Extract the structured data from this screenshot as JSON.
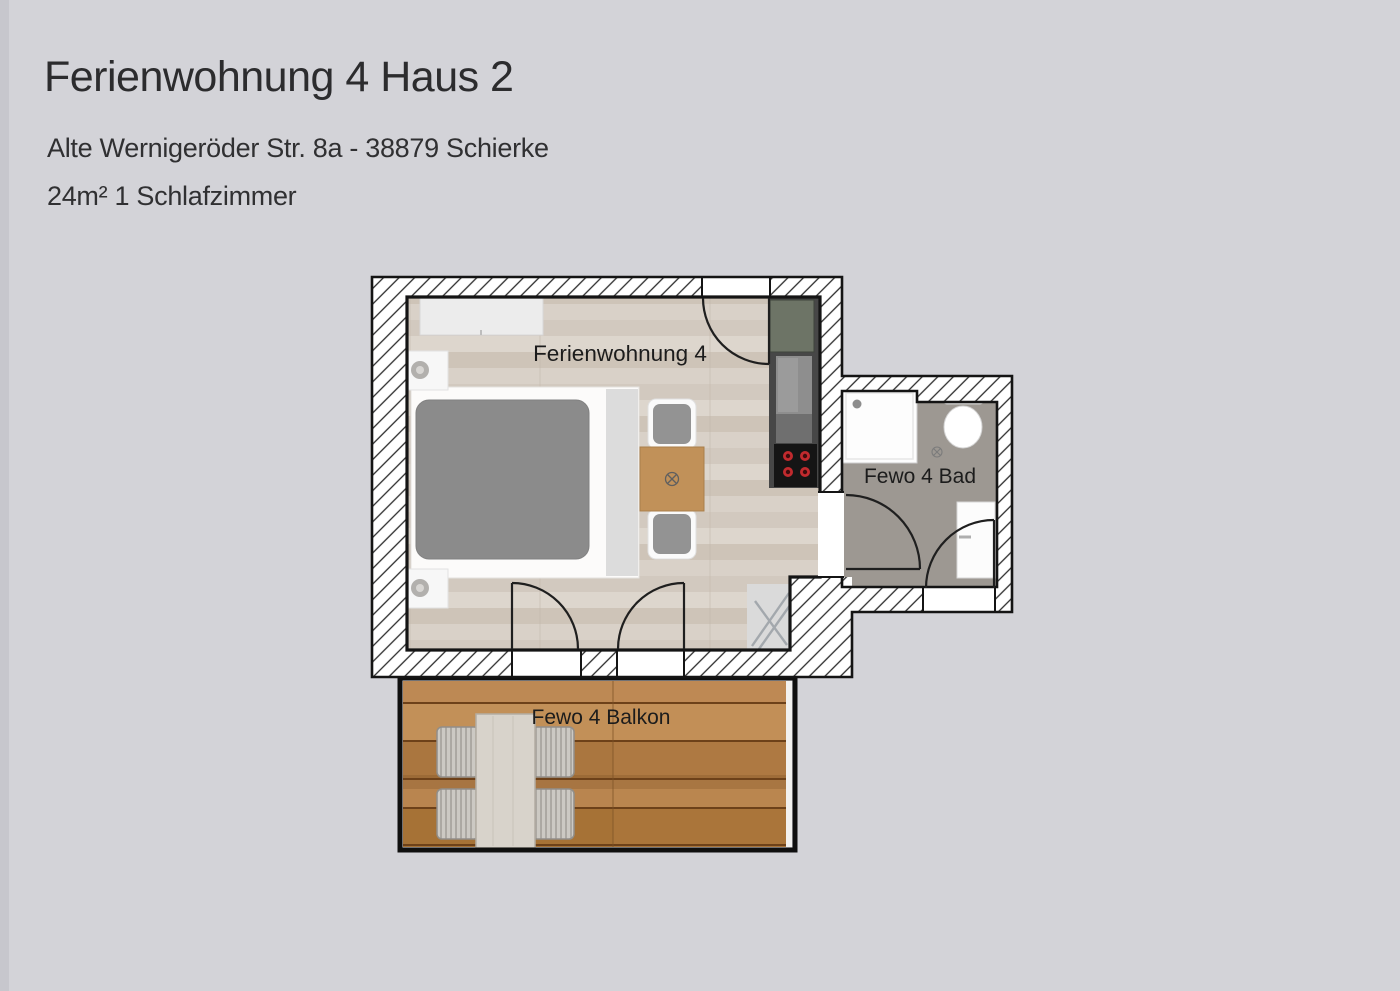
{
  "header": {
    "title": "Ferienwohnung 4 Haus 2",
    "address": "Alte Wernigeröder Str. 8a - 38879 Schierke",
    "details": "24m² 1 Schlafzimmer"
  },
  "floorplan": {
    "room_label": "Ferienwohnung 4",
    "bathroom_label": "Fewo 4 Bad",
    "balcony_label": "Fewo 4 Balkon"
  },
  "colors": {
    "background": "#d3d3d8",
    "wall_outline": "#141414",
    "wood_floor": "#d7cfc6",
    "bath_floor": "#9d9892",
    "balcony_deck": "#b5804a",
    "mattress_gray": "#8b8b8b",
    "dining_table_wood": "#c19159",
    "kitchen_unit_green": "#6d7466",
    "stove_black": "#151515",
    "burner_red": "#c12a2e",
    "balcony_table": "#d8d3cb"
  }
}
